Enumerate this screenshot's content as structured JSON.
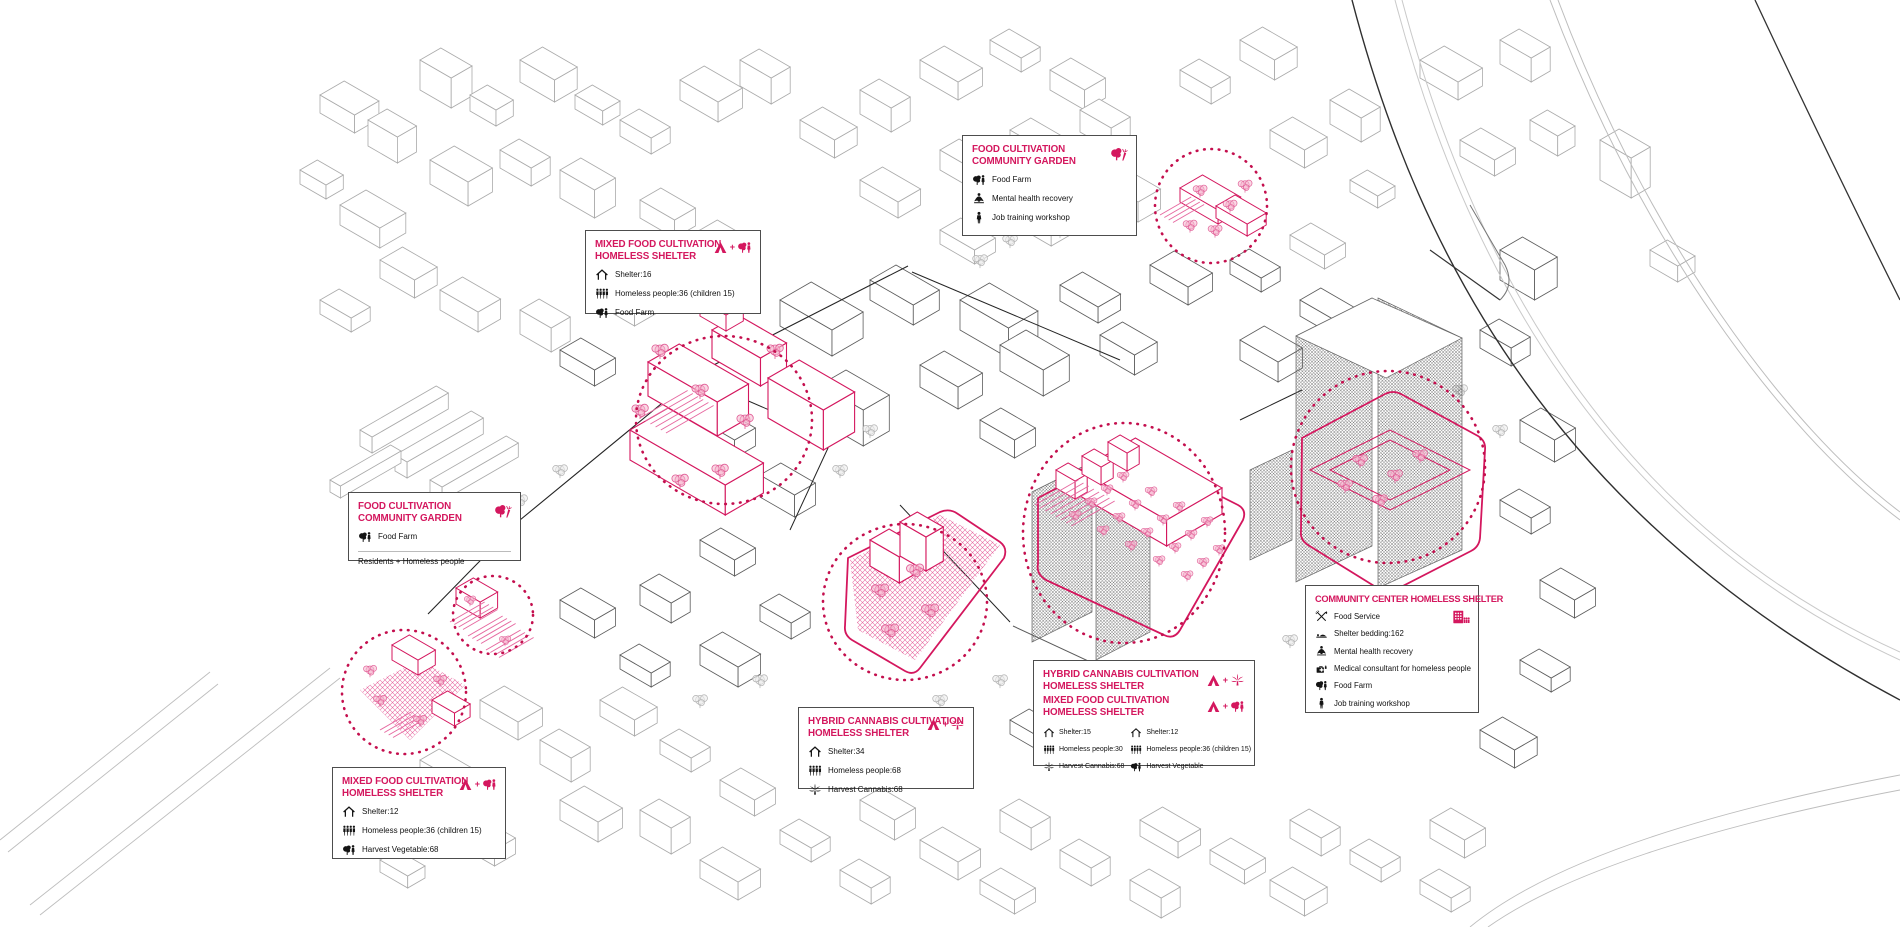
{
  "colors": {
    "accent": "#d4175e",
    "focus_circle": "#c40f4e",
    "line_gray": "#a8a8a8",
    "line_dark": "#2a2a2a",
    "tree_pink": "#ef8ab2",
    "ink": "#111111"
  },
  "misc": {
    "plus": "+"
  },
  "callouts": [
    {
      "id": "food-cultivation-community-garden-north",
      "title_lines": [
        "Food Cultivation",
        "Community Garden"
      ],
      "badge": "tree-carrot",
      "items": [
        {
          "icon": "food-farm",
          "label": "Food Farm"
        },
        {
          "icon": "mental-health",
          "label": "Mental health recovery"
        },
        {
          "icon": "job-training",
          "label": "Job training workshop"
        }
      ]
    },
    {
      "id": "mixed-food-cultivation-homeless-shelter-north",
      "title_lines": [
        "Mixed Food Cultivation",
        "Homeless Shelter"
      ],
      "badge": "tent-plus-farm",
      "items": [
        {
          "icon": "shelter",
          "label": "Shelter:16"
        },
        {
          "icon": "people",
          "label": "Homeless people:36 (children 15)"
        },
        {
          "icon": "food-farm",
          "label": "Food Farm"
        }
      ]
    },
    {
      "id": "food-cultivation-community-garden-west",
      "title_lines": [
        "Food Cultivation",
        "Community Garden"
      ],
      "badge": "tree-carrot",
      "items": [
        {
          "icon": "food-farm",
          "label": "Food Farm"
        }
      ],
      "footer": "Residents + Homeless people"
    },
    {
      "id": "mixed-food-cultivation-homeless-shelter-southwest",
      "title_lines": [
        "Mixed Food Cultivation",
        "Homeless Shelter"
      ],
      "badge": "tent-plus-farm",
      "items": [
        {
          "icon": "shelter",
          "label": "Shelter:12"
        },
        {
          "icon": "people",
          "label": "Homeless people:36 (children 15)"
        },
        {
          "icon": "food-farm",
          "label": "Harvest Vegetable:68"
        }
      ]
    },
    {
      "id": "hybrid-cannabis-cultivation-homeless-shelter-south",
      "title_lines": [
        "Hybrid Cannabis Cultivation",
        "Homeless Shelter"
      ],
      "badge": "tent-plus-cannabis",
      "items": [
        {
          "icon": "shelter",
          "label": "Shelter:34"
        },
        {
          "icon": "people",
          "label": "Homeless people:68"
        },
        {
          "icon": "cannabis",
          "label": "Harvest Cannabis:68"
        }
      ]
    },
    {
      "id": "hybrid-cannabis-and-mixed-food-center",
      "titles": [
        {
          "lines": [
            "Hybrid Cannabis Cultivation",
            "Homeless Shelter"
          ],
          "badge": "tent-plus-cannabis"
        },
        {
          "lines": [
            "Mixed Food Cultivation",
            "Homeless Shelter"
          ],
          "badge": "tent-plus-farm"
        }
      ],
      "columns": [
        [
          {
            "icon": "shelter",
            "label": "Shelter:15"
          },
          {
            "icon": "people",
            "label": "Homeless people:30"
          },
          {
            "icon": "cannabis",
            "label": "Harvest Cannabis:68"
          }
        ],
        [
          {
            "icon": "shelter",
            "label": "Shelter:12"
          },
          {
            "icon": "people",
            "label": "Homeless people:36 (children 15)"
          },
          {
            "icon": "food-farm",
            "label": "Harvest Vegetable"
          }
        ]
      ]
    },
    {
      "id": "community-center-homeless-shelter",
      "title_lines": [
        "Community Center Homeless Shelter"
      ],
      "badge": "building-people",
      "items": [
        {
          "icon": "food-service",
          "label": "Food Service"
        },
        {
          "icon": "shelter-bedding",
          "label": "Shelter bedding:162"
        },
        {
          "icon": "mental-health",
          "label": "Mental health recovery"
        },
        {
          "icon": "medical",
          "label": "Medical consultant for homeless people"
        },
        {
          "icon": "food-farm",
          "label": "Food Farm"
        },
        {
          "icon": "job-training",
          "label": "Job training workshop"
        }
      ]
    }
  ]
}
